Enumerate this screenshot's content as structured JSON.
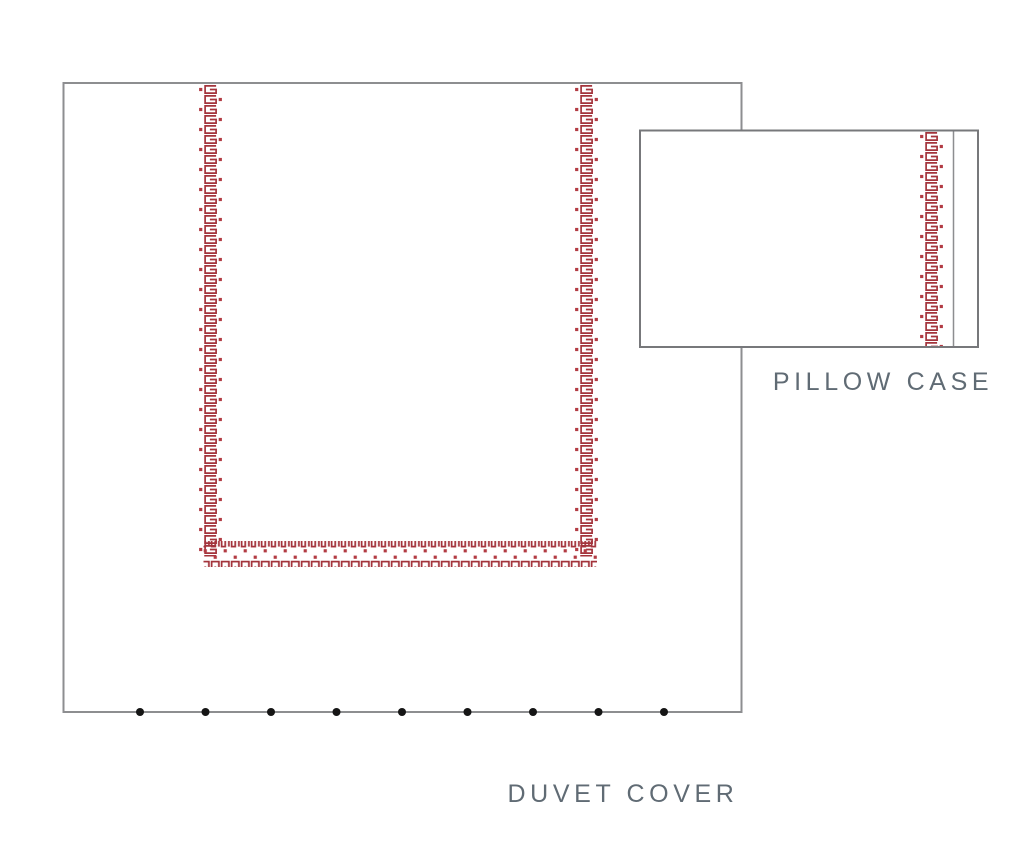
{
  "page": {
    "background": "#ffffff"
  },
  "duvet": {
    "label": "DUVET COVER",
    "button_count": 9,
    "border_pattern": "greek-key-scroll-with-dots"
  },
  "pillow": {
    "label": "PILLOW CASE",
    "border_pattern": "greek-key-scroll-with-dots"
  },
  "colors": {
    "pattern_red": "#a3333b",
    "pattern_dot_red": "#b23b43",
    "outline_gray": "#8d8e90",
    "pillow_outline_gray": "#77787b",
    "seam_gray": "#8d8e90",
    "label_gray": "#606b74",
    "button_black": "#151515"
  }
}
